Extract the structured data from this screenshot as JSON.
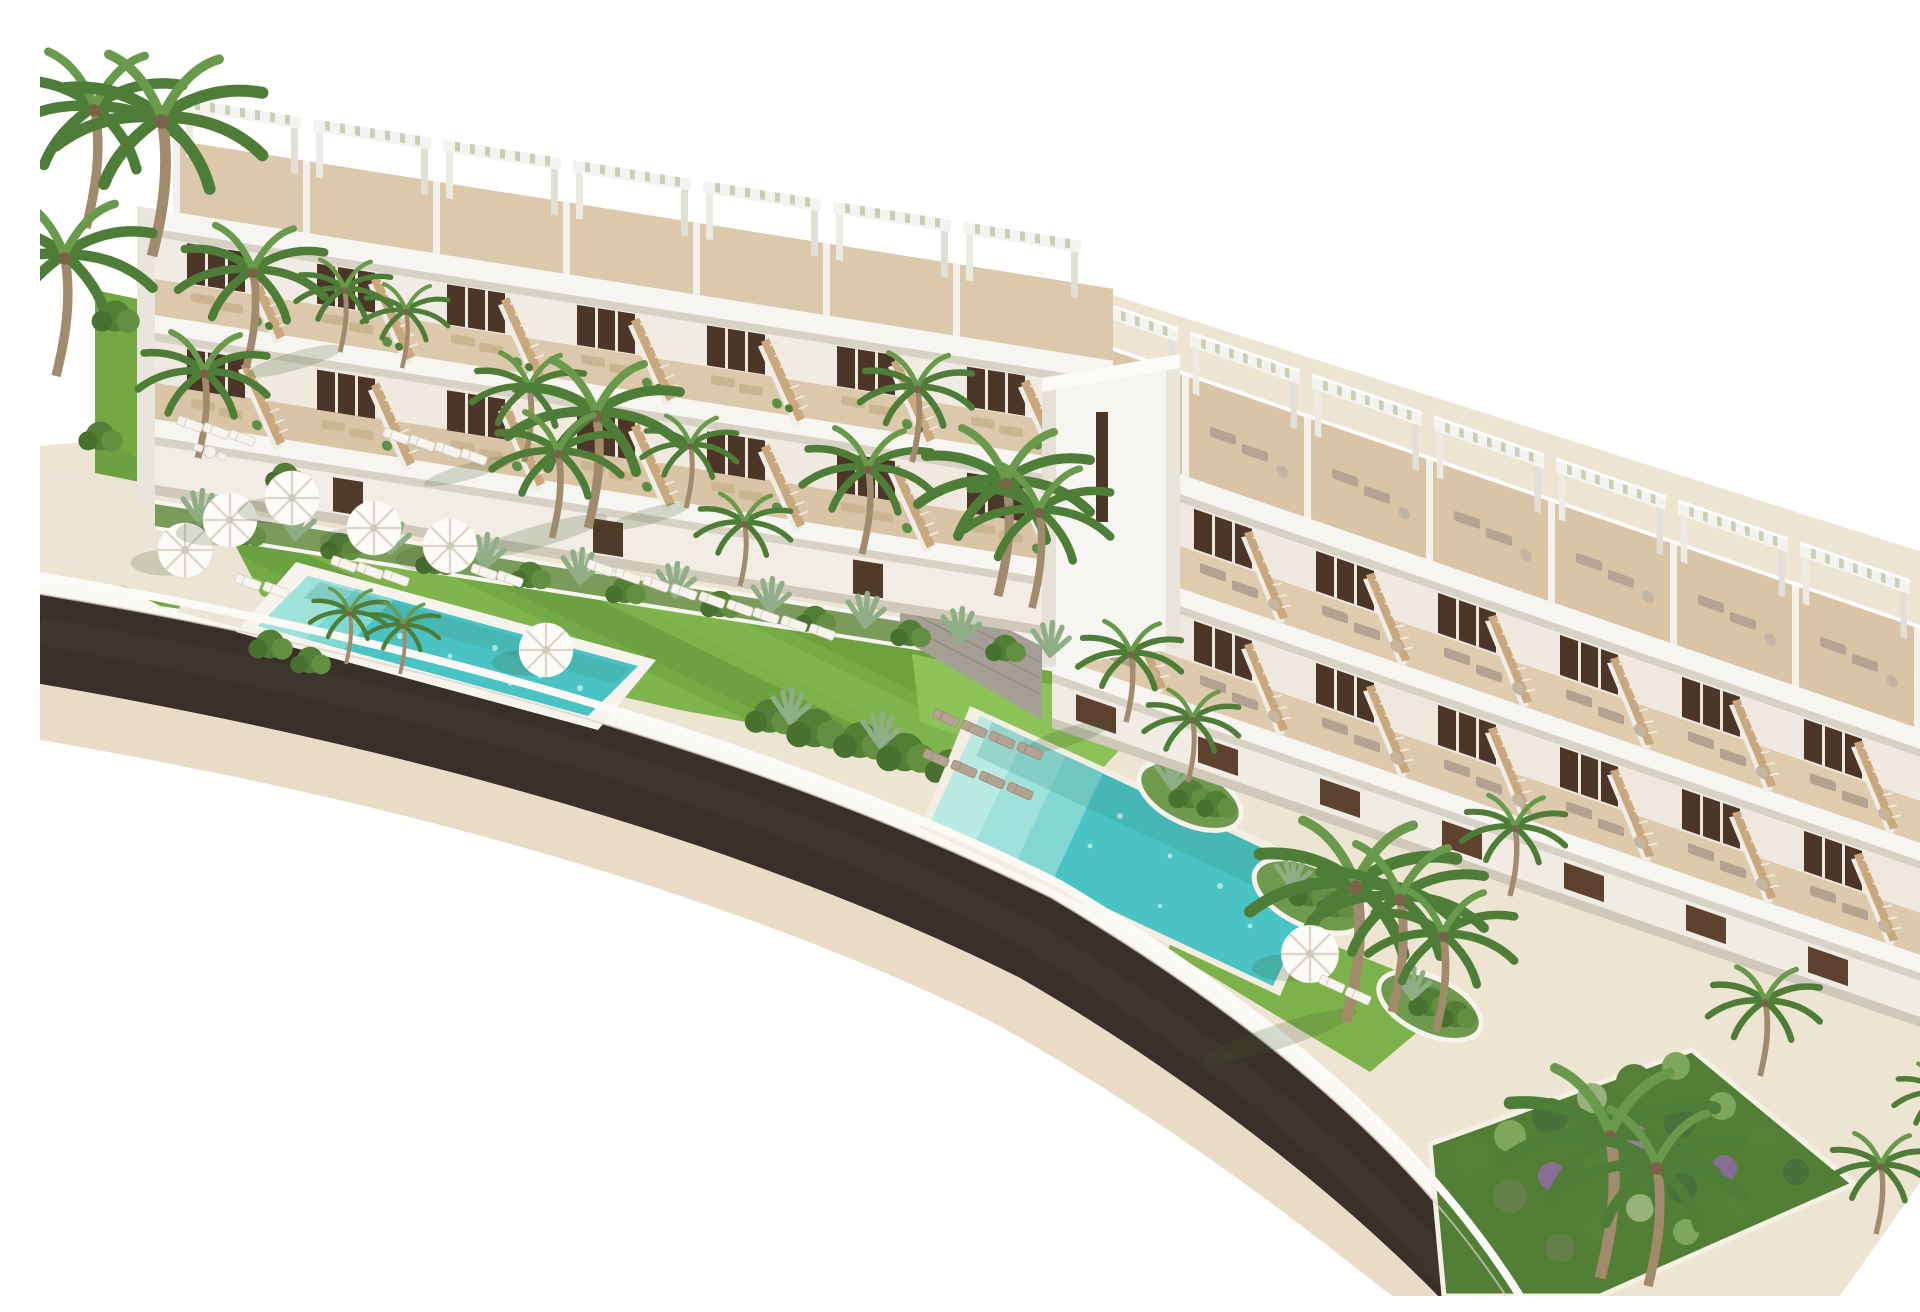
{
  "scene": {
    "kind": "architectural-aerial-render",
    "description": "Aerial 3D real-estate rendering of a modern white terraced apartment complex: two stepped buildings with rooftop pergolas and wooden stairs, a lift tower, landscaped gardens with striped lawns, white parasols and sun loungers, palm trees, two turquoise pools, and a dark curved road with tan sidewalks on a pure white background.",
    "objects": {
      "buildings": 2,
      "lift_towers": 1,
      "rooftop_pergolas": 15,
      "swimming_pools": 2,
      "parasols": 7,
      "sun_loungers": 33,
      "palm_trees": 28,
      "staircases": 30,
      "garden_beds": 6,
      "roads": 1
    }
  },
  "palette": {
    "background": "#ffffff",
    "building_white": "#f7f5f1",
    "wall_tint": "#f0ebe3",
    "slab_shadow": "#d8d1c5",
    "terrace_wood": "#dcc8ab",
    "roof_wood": "#d9c5a6",
    "window_dark": "#4b3628",
    "door_wood": "#503a29",
    "stair_wood": "#c9a87e",
    "pergola_slat": "#c9cfb6",
    "grass": "#74a843",
    "grass_light": "#8cc257",
    "grass_dark": "#5f9638",
    "shrub": "#527e36",
    "agave": "#8fae85",
    "palm": "#4e7d38",
    "palm_light": "#69994a",
    "trunk": "#a28b6c",
    "pool_water": "#49c3c3",
    "pool_shallow": "#9fe2da",
    "deck_white": "#f7f4ed",
    "road_asphalt": "#39302a",
    "sidewalk": "#e8dcc7",
    "curb_white": "#faf8f3",
    "path_tan": "#eee4d2",
    "path_light": "#ebe3d4",
    "lounger_white": "#f7f4ee",
    "lounger_gray": "#b3a291",
    "rattan": "#c3b5a2",
    "umbrella": "#fcfbf8",
    "stone": "#a59f96",
    "wood_clad": "#5d422f",
    "flower_purple": "#8a6d95"
  }
}
